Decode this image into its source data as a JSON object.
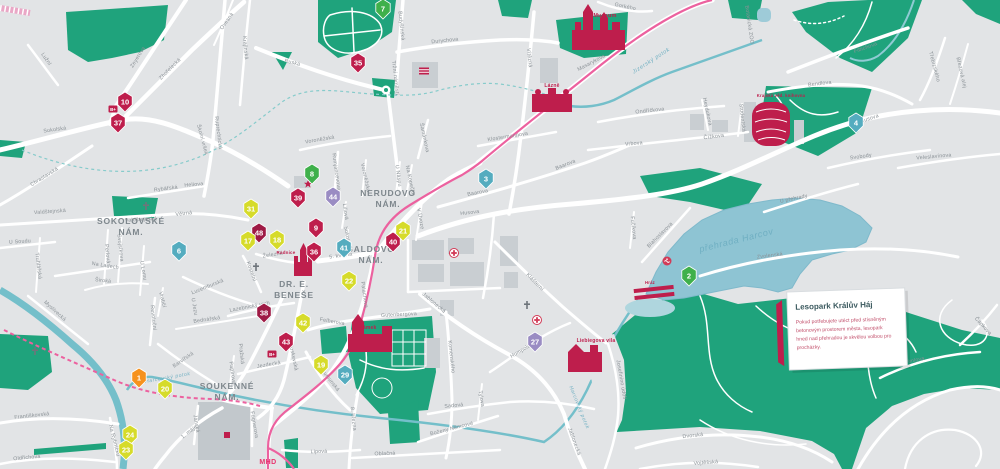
{
  "callout": {
    "title": "Lesopark Králův Háj",
    "lines": [
      "Pokud potřebujete utéct před stísněným",
      "betonovým prostorem města, lesopark",
      "hned nad přehradou je skvělou volbou pro",
      "procházky."
    ]
  },
  "colors": {
    "crimson": "#BE1E4C",
    "darkred": "#9E1A45",
    "yellow": "#D6DB2A",
    "teal": "#54ACBF",
    "purple": "#9A8CC3",
    "mgreen": "#3FB04B",
    "orange": "#F6921E",
    "green": "#1FA37C",
    "water": "#8EC4D3",
    "tram": "#EC619F",
    "label": "#8A9196"
  },
  "squares": [
    {
      "l1": "SOKOLOVSKÉ",
      "l2": "NÁM.",
      "x": 131,
      "y": 224
    },
    {
      "l1": "NERUDOVO",
      "l2": "NÁM.",
      "x": 388,
      "y": 196
    },
    {
      "l1": "ŠALDOVO",
      "l2": "NÁM.",
      "x": 371,
      "y": 252
    },
    {
      "l1": "DR. E.",
      "l2": "BENEŠE",
      "x": 294,
      "y": 287
    },
    {
      "l1": "SOUKENNÉ",
      "l2": "NÁM.",
      "x": 227,
      "y": 389
    }
  ],
  "landmarks": [
    {
      "t": "Muzeum",
      "x": 605,
      "y": 17,
      "s": 5.5
    },
    {
      "t": "Lázně",
      "x": 552,
      "y": 87,
      "s": 5
    },
    {
      "t": "Radnice",
      "x": 286,
      "y": 254,
      "s": 4.5
    },
    {
      "t": "Zámek",
      "x": 368,
      "y": 329,
      "s": 5
    },
    {
      "t": "Liebiegova vila",
      "x": 596,
      "y": 342,
      "s": 5
    },
    {
      "t": "Krajská věd. knihovna",
      "x": 781,
      "y": 97,
      "s": 4.2
    },
    {
      "t": "Hráz",
      "x": 650,
      "y": 284,
      "s": 4.2
    },
    {
      "t": "MHD",
      "x": 268,
      "y": 464,
      "s": 7,
      "cls": "mhd"
    }
  ],
  "water_labels": [
    {
      "t": "přehrada Harcov",
      "x": 737,
      "y": 243,
      "r": -14,
      "s": 9
    },
    {
      "t": "Jizerský potok",
      "x": 652,
      "y": 62,
      "r": -33,
      "s": 5.5
    },
    {
      "t": "Harcovský potok",
      "x": 578,
      "y": 408,
      "r": 68,
      "s": 5
    },
    {
      "t": "Harcovský potok",
      "x": 168,
      "y": 379,
      "r": -10,
      "s": 5
    }
  ],
  "markers": [
    {
      "n": "7",
      "c": "mgreen",
      "x": 383,
      "y": 9
    },
    {
      "n": "35",
      "c": "crimson",
      "x": 358,
      "y": 63
    },
    {
      "n": "10",
      "c": "crimson",
      "x": 125,
      "y": 102
    },
    {
      "n": "37",
      "c": "crimson",
      "x": 118,
      "y": 123
    },
    {
      "n": "8",
      "c": "mgreen",
      "x": 312,
      "y": 174
    },
    {
      "n": "39",
      "c": "crimson",
      "x": 298,
      "y": 198
    },
    {
      "n": "44",
      "c": "purple",
      "x": 333,
      "y": 197
    },
    {
      "n": "31",
      "c": "yellow",
      "x": 251,
      "y": 209
    },
    {
      "n": "48",
      "c": "darkred",
      "x": 259,
      "y": 233
    },
    {
      "n": "17",
      "c": "yellow",
      "x": 248,
      "y": 241
    },
    {
      "n": "18",
      "c": "yellow",
      "x": 277,
      "y": 240
    },
    {
      "n": "9",
      "c": "crimson",
      "x": 316,
      "y": 228
    },
    {
      "n": "36",
      "c": "crimson",
      "x": 314,
      "y": 252
    },
    {
      "n": "41",
      "c": "teal",
      "x": 344,
      "y": 248
    },
    {
      "n": "40",
      "c": "crimson",
      "x": 393,
      "y": 242
    },
    {
      "n": "21",
      "c": "yellow",
      "x": 403,
      "y": 231
    },
    {
      "n": "22",
      "c": "yellow",
      "x": 349,
      "y": 281
    },
    {
      "n": "6",
      "c": "teal",
      "x": 179,
      "y": 251
    },
    {
      "n": "3",
      "c": "teal",
      "x": 486,
      "y": 179
    },
    {
      "n": "4",
      "c": "teal",
      "x": 856,
      "y": 123
    },
    {
      "n": "2",
      "c": "mgreen",
      "x": 689,
      "y": 276
    },
    {
      "n": "38",
      "c": "darkred",
      "x": 264,
      "y": 313
    },
    {
      "n": "42",
      "c": "yellow",
      "x": 303,
      "y": 323
    },
    {
      "n": "43",
      "c": "crimson",
      "x": 286,
      "y": 342
    },
    {
      "n": "19",
      "c": "yellow",
      "x": 321,
      "y": 365
    },
    {
      "n": "29",
      "c": "teal",
      "x": 345,
      "y": 375
    },
    {
      "n": "27",
      "c": "purple",
      "x": 535,
      "y": 342
    },
    {
      "n": "1",
      "c": "orange",
      "x": 139,
      "y": 378
    },
    {
      "n": "20",
      "c": "yellow",
      "x": 165,
      "y": 389
    },
    {
      "n": "24",
      "c": "yellow",
      "x": 130,
      "y": 435
    },
    {
      "n": "23",
      "c": "yellow",
      "x": 126,
      "y": 450
    }
  ],
  "icons": [
    {
      "k": "star",
      "x": 308,
      "y": 184
    },
    {
      "k": "parking",
      "x": 113,
      "y": 109
    },
    {
      "k": "parking",
      "x": 272,
      "y": 354
    },
    {
      "k": "church",
      "x": 146,
      "y": 206
    },
    {
      "k": "church",
      "x": 256,
      "y": 267
    },
    {
      "k": "church",
      "x": 35,
      "y": 351
    },
    {
      "k": "church",
      "x": 527,
      "y": 305
    },
    {
      "k": "hospital",
      "x": 454,
      "y": 253
    },
    {
      "k": "hospital",
      "x": 537,
      "y": 320
    },
    {
      "k": "swim",
      "x": 667,
      "y": 261
    },
    {
      "k": "flag",
      "x": 424,
      "y": 71
    },
    {
      "k": "mall",
      "x": 227,
      "y": 435
    },
    {
      "k": "roundabout",
      "x": 386,
      "y": 90
    }
  ],
  "streets": [
    {
      "t": "Lužní",
      "x": 45,
      "y": 60,
      "r": 55
    },
    {
      "t": "Sokolská",
      "x": 55,
      "y": 131,
      "r": -8
    },
    {
      "t": "Zeyerova",
      "x": 139,
      "y": 58,
      "r": -58
    },
    {
      "t": "Zhořelecká",
      "x": 171,
      "y": 70,
      "r": -45
    },
    {
      "t": "Ovesná",
      "x": 228,
      "y": 22,
      "r": -55
    },
    {
      "t": "Krajinská",
      "x": 244,
      "y": 48,
      "r": 85
    },
    {
      "t": "Ruprechtická",
      "x": 217,
      "y": 133,
      "r": 83
    },
    {
      "t": "Školní vršek",
      "x": 201,
      "y": 140,
      "r": 75
    },
    {
      "t": "Ruská",
      "x": 292,
      "y": 64,
      "r": 14
    },
    {
      "t": "Budyšínská",
      "x": 400,
      "y": 26,
      "r": 84
    },
    {
      "t": "Tržní náměstí",
      "x": 394,
      "y": 78,
      "r": 84
    },
    {
      "t": "Durychova",
      "x": 445,
      "y": 42,
      "r": -6
    },
    {
      "t": "Šamánkova",
      "x": 423,
      "y": 138,
      "r": 78
    },
    {
      "t": "Voroněžská",
      "x": 320,
      "y": 141,
      "r": -10
    },
    {
      "t": "Voroněžská",
      "x": 364,
      "y": 178,
      "r": 78
    },
    {
      "t": "Gorkého",
      "x": 625,
      "y": 8,
      "r": 12
    },
    {
      "t": "Masarykova",
      "x": 592,
      "y": 64,
      "r": -28
    },
    {
      "t": "Vítězná",
      "x": 528,
      "y": 58,
      "r": 84
    },
    {
      "t": "Klostermannova",
      "x": 508,
      "y": 138,
      "r": -9
    },
    {
      "t": "Ondříčkova",
      "x": 650,
      "y": 112,
      "r": -6
    },
    {
      "t": "Vrbova",
      "x": 634,
      "y": 145,
      "r": -5
    },
    {
      "t": "Čížkova",
      "x": 714,
      "y": 138,
      "r": -7
    },
    {
      "t": "Studentská",
      "x": 741,
      "y": 118,
      "r": 84
    },
    {
      "t": "Heydukova",
      "x": 706,
      "y": 112,
      "r": 78
    },
    {
      "t": "Fibichova",
      "x": 866,
      "y": 49,
      "r": -20
    },
    {
      "t": "Bendlova",
      "x": 820,
      "y": 85,
      "r": -7
    },
    {
      "t": "Třebízského",
      "x": 933,
      "y": 67,
      "r": 75
    },
    {
      "t": "Březová alej",
      "x": 960,
      "y": 73,
      "r": 77
    },
    {
      "t": "Husova",
      "x": 870,
      "y": 120,
      "r": -19
    },
    {
      "t": "Husova",
      "x": 470,
      "y": 214,
      "r": -7
    },
    {
      "t": "Svobody",
      "x": 861,
      "y": 158,
      "r": -8
    },
    {
      "t": "Veleslavínova",
      "x": 934,
      "y": 158,
      "r": -5
    },
    {
      "t": "U přehrady",
      "x": 794,
      "y": 200,
      "r": -12
    },
    {
      "t": "Blahoslavova",
      "x": 661,
      "y": 236,
      "r": -45
    },
    {
      "t": "Fučíkova",
      "x": 632,
      "y": 228,
      "r": 84
    },
    {
      "t": "Zvolenská",
      "x": 770,
      "y": 257,
      "r": -7
    },
    {
      "t": "Baarova",
      "x": 478,
      "y": 194,
      "r": -11
    },
    {
      "t": "Baarova",
      "x": 566,
      "y": 166,
      "r": -22
    },
    {
      "t": "Na Kopečku",
      "x": 409,
      "y": 181,
      "r": 78
    },
    {
      "t": "U Náspu",
      "x": 397,
      "y": 176,
      "r": 82
    },
    {
      "t": "V Úvoze",
      "x": 419,
      "y": 219,
      "r": 80
    },
    {
      "t": "Rumjancevova",
      "x": 335,
      "y": 172,
      "r": 82
    },
    {
      "t": "Liliová",
      "x": 344,
      "y": 212,
      "r": 82
    },
    {
      "t": "Sokolská",
      "x": 346,
      "y": 238,
      "r": 82
    },
    {
      "t": "5. května",
      "x": 341,
      "y": 257,
      "r": -8
    },
    {
      "t": "Železná",
      "x": 273,
      "y": 256,
      "r": -9
    },
    {
      "t": "Kostelní",
      "x": 250,
      "y": 272,
      "r": 70
    },
    {
      "t": "Moskevská",
      "x": 292,
      "y": 357,
      "r": 78
    },
    {
      "t": "Pražská",
      "x": 240,
      "y": 354,
      "r": 84
    },
    {
      "t": "Jezdecká",
      "x": 269,
      "y": 366,
      "r": -10
    },
    {
      "t": "Papírová",
      "x": 231,
      "y": 373,
      "r": 82
    },
    {
      "t": "Lazebnický vrch",
      "x": 250,
      "y": 308,
      "r": -11
    },
    {
      "t": "Lucemburská",
      "x": 208,
      "y": 288,
      "r": -22
    },
    {
      "t": "Bednářská",
      "x": 207,
      "y": 321,
      "r": -8
    },
    {
      "t": "Barvířská",
      "x": 184,
      "y": 361,
      "r": -35
    },
    {
      "t": "Revoluční",
      "x": 152,
      "y": 318,
      "r": 84
    },
    {
      "t": "Vrabčí",
      "x": 161,
      "y": 300,
      "r": 76
    },
    {
      "t": "U Jezu",
      "x": 193,
      "y": 307,
      "r": 80
    },
    {
      "t": "Široká",
      "x": 103,
      "y": 282,
      "r": 6
    },
    {
      "t": "Na Ladech",
      "x": 105,
      "y": 267,
      "r": 9
    },
    {
      "t": "U Soudu",
      "x": 20,
      "y": 243,
      "r": -4
    },
    {
      "t": "Truhlářská",
      "x": 37,
      "y": 266,
      "r": 83
    },
    {
      "t": "Perlová",
      "x": 106,
      "y": 254,
      "r": 84
    },
    {
      "t": "Svojsíkova",
      "x": 119,
      "y": 248,
      "r": 84
    },
    {
      "t": "U Lomu",
      "x": 142,
      "y": 271,
      "r": 80
    },
    {
      "t": "Valdštejnská",
      "x": 50,
      "y": 213,
      "r": -4
    },
    {
      "t": "Valdštejnská",
      "x": 141,
      "y": 221,
      "r": -3
    },
    {
      "t": "Chrastavská",
      "x": 45,
      "y": 178,
      "r": -32
    },
    {
      "t": "Rybářská",
      "x": 166,
      "y": 190,
      "r": -7
    },
    {
      "t": "Heliova",
      "x": 194,
      "y": 186,
      "r": -5
    },
    {
      "t": "Větrná",
      "x": 184,
      "y": 215,
      "r": -6
    },
    {
      "t": "Myslivecká",
      "x": 54,
      "y": 312,
      "r": 42
    },
    {
      "t": "Františkovská",
      "x": 32,
      "y": 417,
      "r": -6
    },
    {
      "t": "Oldřichova",
      "x": 27,
      "y": 459,
      "r": -5
    },
    {
      "t": "Na Rybníčku",
      "x": 113,
      "y": 441,
      "r": 76
    },
    {
      "t": "1. máje",
      "x": 190,
      "y": 433,
      "r": -38
    },
    {
      "t": "Jánská",
      "x": 195,
      "y": 424,
      "r": 80
    },
    {
      "t": "Fügnerova",
      "x": 253,
      "y": 425,
      "r": 80
    },
    {
      "t": "Felberova",
      "x": 332,
      "y": 323,
      "r": 10
    },
    {
      "t": "Gutenbergova",
      "x": 399,
      "y": 316,
      "r": -3
    },
    {
      "t": "Palachova",
      "x": 363,
      "y": 295,
      "r": 82
    },
    {
      "t": "Rumunská",
      "x": 329,
      "y": 381,
      "r": 52
    },
    {
      "t": "Jablonecká",
      "x": 433,
      "y": 304,
      "r": 40
    },
    {
      "t": "Komenského",
      "x": 450,
      "y": 357,
      "r": 84
    },
    {
      "t": "8. března",
      "x": 352,
      "y": 419,
      "r": 84
    },
    {
      "t": "Lipová",
      "x": 319,
      "y": 453,
      "r": -2
    },
    {
      "t": "Oblačná",
      "x": 385,
      "y": 455,
      "r": -2
    },
    {
      "t": "Boženy Němcové",
      "x": 452,
      "y": 430,
      "r": -14
    },
    {
      "t": "Sadová",
      "x": 454,
      "y": 407,
      "r": -5
    },
    {
      "t": "Tylova",
      "x": 480,
      "y": 399,
      "r": 80
    },
    {
      "t": "Klášterní",
      "x": 534,
      "y": 283,
      "r": 45
    },
    {
      "t": "Humpolecká",
      "x": 525,
      "y": 350,
      "r": -31
    },
    {
      "t": "Jablonecká",
      "x": 573,
      "y": 442,
      "r": 70
    },
    {
      "t": "Josefinino údolí",
      "x": 620,
      "y": 380,
      "r": 80
    },
    {
      "t": "Dvorská",
      "x": 693,
      "y": 437,
      "r": -6
    },
    {
      "t": "Vojtěšská",
      "x": 706,
      "y": 464,
      "r": -4
    },
    {
      "t": "Frimlova",
      "x": 914,
      "y": 362,
      "r": -12
    },
    {
      "t": "Čapkova",
      "x": 982,
      "y": 327,
      "r": 48
    },
    {
      "t": "Botanická ZOO",
      "x": 748,
      "y": 25,
      "r": 82
    }
  ]
}
